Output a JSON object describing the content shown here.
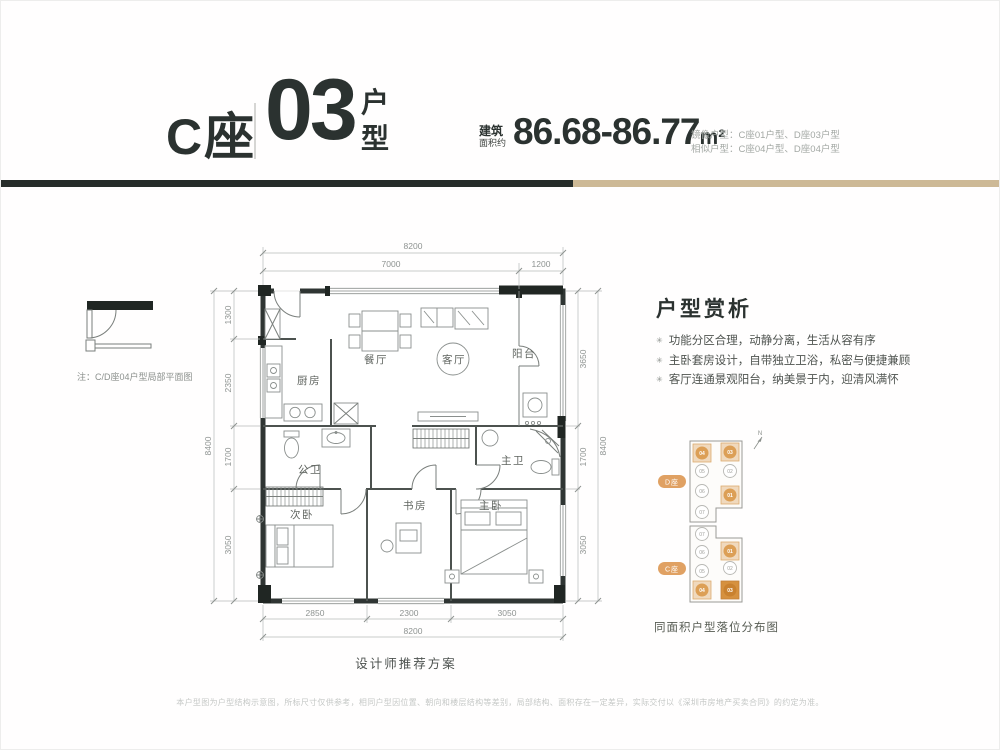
{
  "header": {
    "block_label": "C座",
    "unit_number": "03",
    "unit_type_chars": {
      "top": "户",
      "bottom": "型"
    },
    "area_prefix_1": "建筑",
    "area_prefix_2": "面积约",
    "area_value": "86.68-86.77",
    "area_unit": "m²",
    "note_mirror": "镜像户型：C座01户型、D座03户型",
    "note_similar": "相似户型：C座04户型、D座04户型"
  },
  "partial_plan": {
    "note": "注：C/D座04户型局部平面图"
  },
  "floor_plan": {
    "caption": "设计师推荐方案",
    "rooms": {
      "kitchen": "厨房",
      "dining": "餐厅",
      "living": "客厅",
      "balcony": "阳台",
      "public_bath": "公卫",
      "master_bath": "主卫",
      "second_bedroom": "次卧",
      "study": "书房",
      "master_bedroom": "主卧"
    },
    "dims": {
      "top_total": "8200",
      "top_left": "7000",
      "top_right": "1200",
      "left_total": "8400",
      "left_1": "1300",
      "left_2": "2350",
      "left_3": "1700",
      "left_4": "3050",
      "right_total": "8400",
      "right_1": "3650",
      "right_2": "1700",
      "right_3": "3050",
      "bottom_total": "8200",
      "bottom_1": "2850",
      "bottom_2": "2300",
      "bottom_3": "3050"
    }
  },
  "analysis": {
    "title": "户型赏析",
    "bullet_icon": "✳",
    "bullets": [
      "功能分区合理，动静分离，生活从容有序",
      "主卧套房设计，自带独立卫浴，私密与便捷兼顾",
      "客厅连通景观阳台，纳美景于内，迎清风满怀"
    ]
  },
  "site_map": {
    "caption": "同面积户型落位分布图",
    "north_label": "N",
    "blocks": [
      {
        "name": "D座",
        "units": [
          {
            "no": "04",
            "state": "highlight"
          },
          {
            "no": "03",
            "state": "highlight"
          },
          {
            "no": "05",
            "state": "normal"
          },
          {
            "no": "02",
            "state": "normal"
          },
          {
            "no": "06",
            "state": "normal"
          },
          {
            "no": "01",
            "state": "highlight"
          },
          {
            "no": "07",
            "state": "normal"
          }
        ]
      },
      {
        "name": "C座",
        "units": [
          {
            "no": "07",
            "state": "normal"
          },
          {
            "no": "06",
            "state": "normal"
          },
          {
            "no": "01",
            "state": "highlight"
          },
          {
            "no": "05",
            "state": "normal"
          },
          {
            "no": "02",
            "state": "normal"
          },
          {
            "no": "04",
            "state": "highlight"
          },
          {
            "no": "03",
            "state": "current"
          }
        ]
      }
    ]
  },
  "disclaimer": "本户型图为户型结构示意图，所标尺寸仅供参考，相同户型因位置、朝向和楼层结构等差别，局部结构、面积存在一定差异，实际交付以《深圳市房地产买卖合同》的约定为准。",
  "colors": {
    "dark_ink": "#2b3230",
    "divider_dark": "#272d2a",
    "divider_tan": "#cdb996",
    "accent_orange": "#dfa05e",
    "tile_light": "#f0d9bd",
    "tile_current": "#d6913f"
  }
}
